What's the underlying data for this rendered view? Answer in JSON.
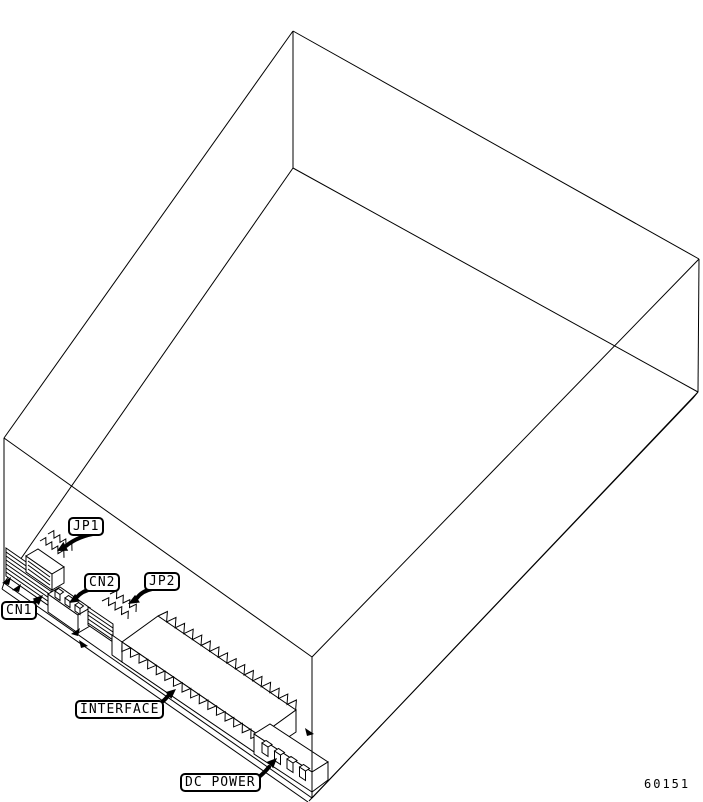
{
  "figure": {
    "number": "60151",
    "background": "#ffffff",
    "line_color": "#000000"
  },
  "callouts": [
    {
      "id": "jp1",
      "label": "JP1"
    },
    {
      "id": "cn2",
      "label": "CN2"
    },
    {
      "id": "jp2",
      "label": "JP2"
    },
    {
      "id": "cn1",
      "label": "CN1"
    },
    {
      "id": "interface",
      "label": "INTERFACE"
    },
    {
      "id": "dc-power",
      "label": "DC POWER"
    }
  ]
}
